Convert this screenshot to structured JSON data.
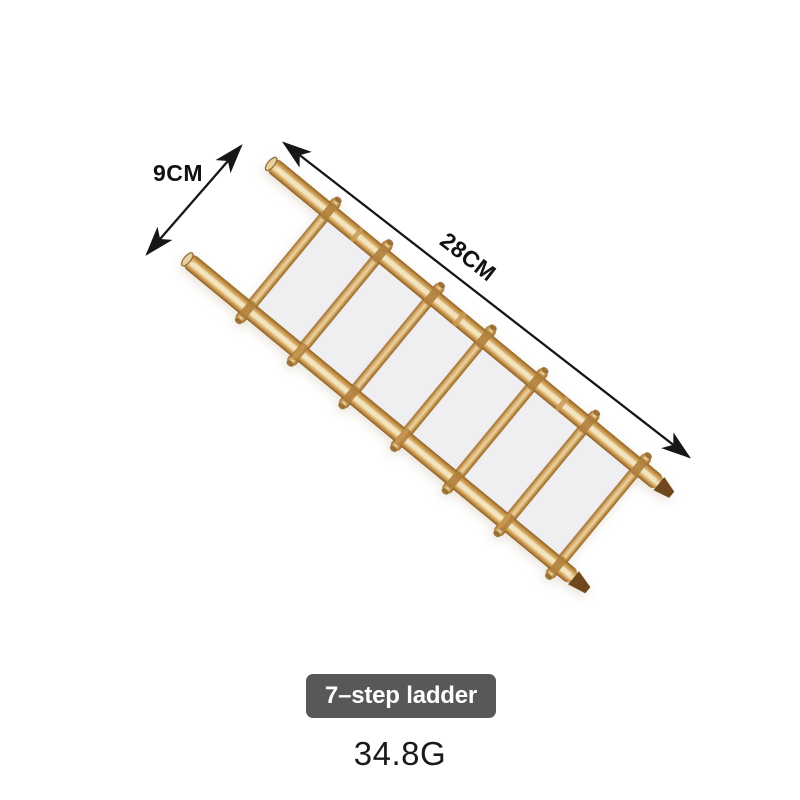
{
  "dimensions": {
    "width_label": "9CM",
    "length_label": "28CM"
  },
  "badge": {
    "label": "7–step ladder"
  },
  "weight": {
    "value": "34.8G"
  },
  "ladder": {
    "steps": 7,
    "colors": {
      "bamboo_highlight": "#f6e9c8",
      "bamboo_mid": "#d8a95f",
      "bamboo_shadow": "#8f6126",
      "bamboo_tip_dark": "#70471a",
      "bamboo_cut_face": "#e9d2a2",
      "node": "#b0803c",
      "node_light": "#c79a52",
      "panel": "#efeff2"
    }
  },
  "style": {
    "background": "#ffffff",
    "arrow_color": "#161616",
    "dimension_text_color": "#111111",
    "badge_background": "#58585a",
    "badge_text_color": "#ffffff",
    "weight_text_color": "#1a1a1a"
  }
}
